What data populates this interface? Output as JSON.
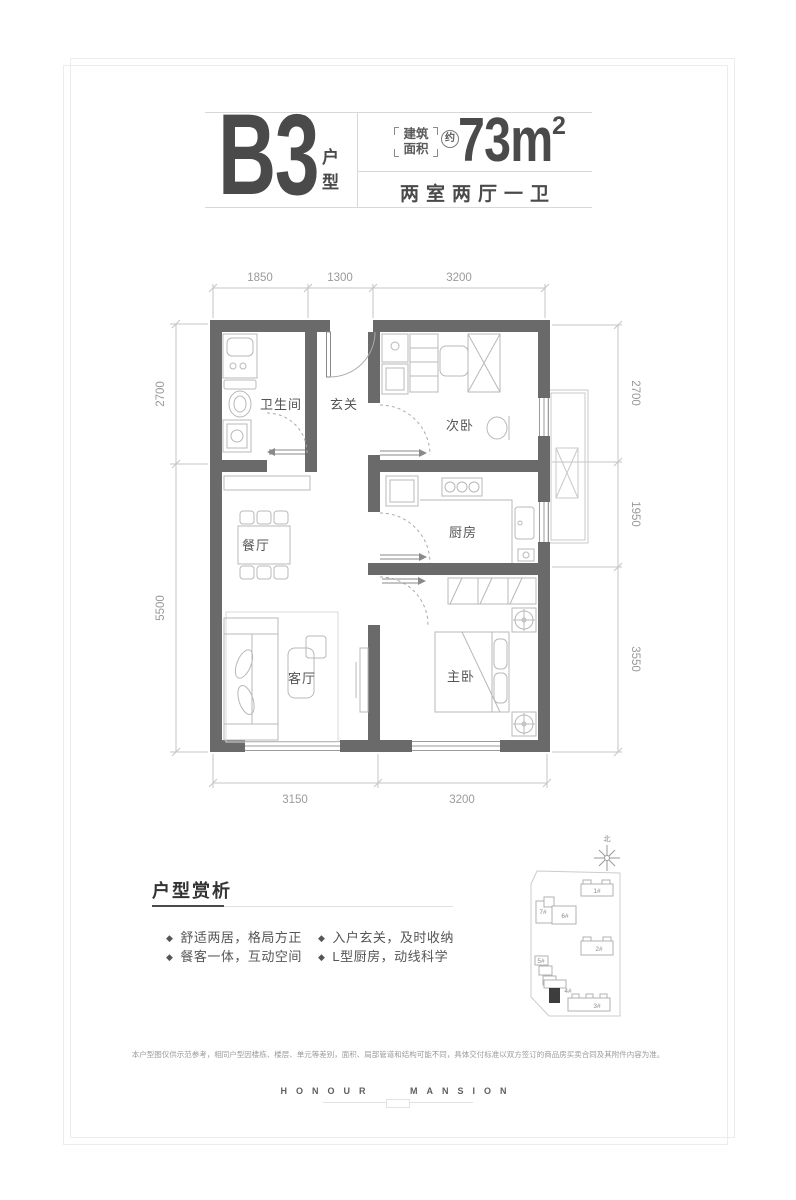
{
  "header": {
    "unit_code": "B3",
    "unit_suffix_top": "户",
    "unit_suffix_bottom": "型",
    "area_bracket_top": "建筑",
    "area_bracket_bottom": "面积",
    "approx_badge": "约",
    "area_number": "73m",
    "area_exponent": "2",
    "layout_summary": "两室两厅一卫"
  },
  "floor_plan": {
    "rooms": {
      "bathroom": "卫生间",
      "foyer": "玄关",
      "second_bedroom": "次卧",
      "dining": "餐厅",
      "kitchen": "厨房",
      "living": "客厅",
      "master_bedroom": "主卧"
    },
    "dimensions": {
      "top": [
        "1850",
        "1300",
        "3200"
      ],
      "bottom": [
        "3150",
        "3200"
      ],
      "left": [
        "2700",
        "5500"
      ],
      "right": [
        "2700",
        "1950",
        "3550"
      ]
    }
  },
  "site_map": {
    "north_label": "北",
    "buildings": {
      "b1": "1#",
      "b2": "2#",
      "b3": "3#",
      "b4": "4#",
      "b5": "5#",
      "b6": "6#",
      "b7": "7#"
    },
    "highlighted_building": "4#"
  },
  "analysis": {
    "title": "户型赏析",
    "bullet_icon": "◆",
    "items": [
      "舒适两居，格局方正",
      "餐客一体，互动空间",
      "入户玄关，及时收纳",
      "L型厨房，动线科学"
    ]
  },
  "footer": {
    "disclaimer": "本户型图仅供示范参考，相同户型因楼栋、楼层、单元等差别，面积、局部管道和结构可能不同，具体交付标准以双方签订的商品房买卖合同及其附件内容为准。",
    "brand": "HONOUR MANSION"
  }
}
